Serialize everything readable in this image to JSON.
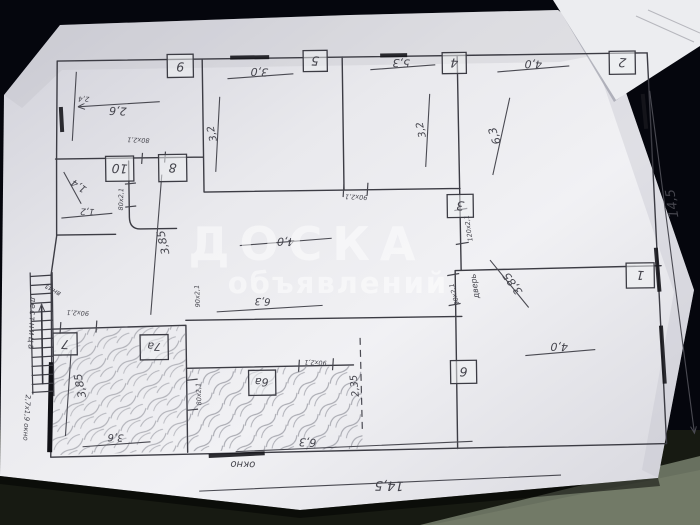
{
  "watermark": {
    "line1": "ДОСКА",
    "line2": "объявлений"
  },
  "plan": {
    "overall": {
      "width": "14,5",
      "height": "14,5"
    },
    "labels": {
      "window_bottom": "окно",
      "window_left_size": "2,7x1,9 окно",
      "stairs": "лестница",
      "stairs_note": "вниз",
      "door_word": "дверь"
    },
    "rooms": {
      "r1": "1",
      "r2": "2",
      "r3": "3",
      "r4": "4",
      "r5": "5",
      "r6": "6",
      "r6a": "6а",
      "r7": "7",
      "r7a": "7а",
      "r8": "8",
      "r9": "9",
      "r10": "10"
    },
    "dims": {
      "r9_w": "2,6",
      "r9_h": "2,4",
      "r10_a": "1,4",
      "r10_b": "1,2",
      "r5_w": "3,0",
      "r5_h": "3,2",
      "r4_w": "5,3",
      "r4_h": "3,2",
      "r2_w": "4,0",
      "r2_h": "6,3",
      "r3_w": "4,0",
      "hall_v": "3,85",
      "hall_w": "6,3",
      "r1_d": "3,85",
      "r1_w": "4,0",
      "r7a_h": "3,85",
      "r7a_w": "3,6",
      "r6_w": "6,3",
      "r6_split": "2,35"
    },
    "doors": {
      "d80_top": "80x2,1",
      "d80_side": "80x2,1",
      "d80_room6a": "80x2,1",
      "d90_hall": "90x2,1",
      "d90_mid": "90x2,1",
      "d90_room6": "90x2,1",
      "d90_room7a": "90x2,1",
      "d90_room1": "90x2,1",
      "d120_room3": "120x2,1"
    }
  }
}
